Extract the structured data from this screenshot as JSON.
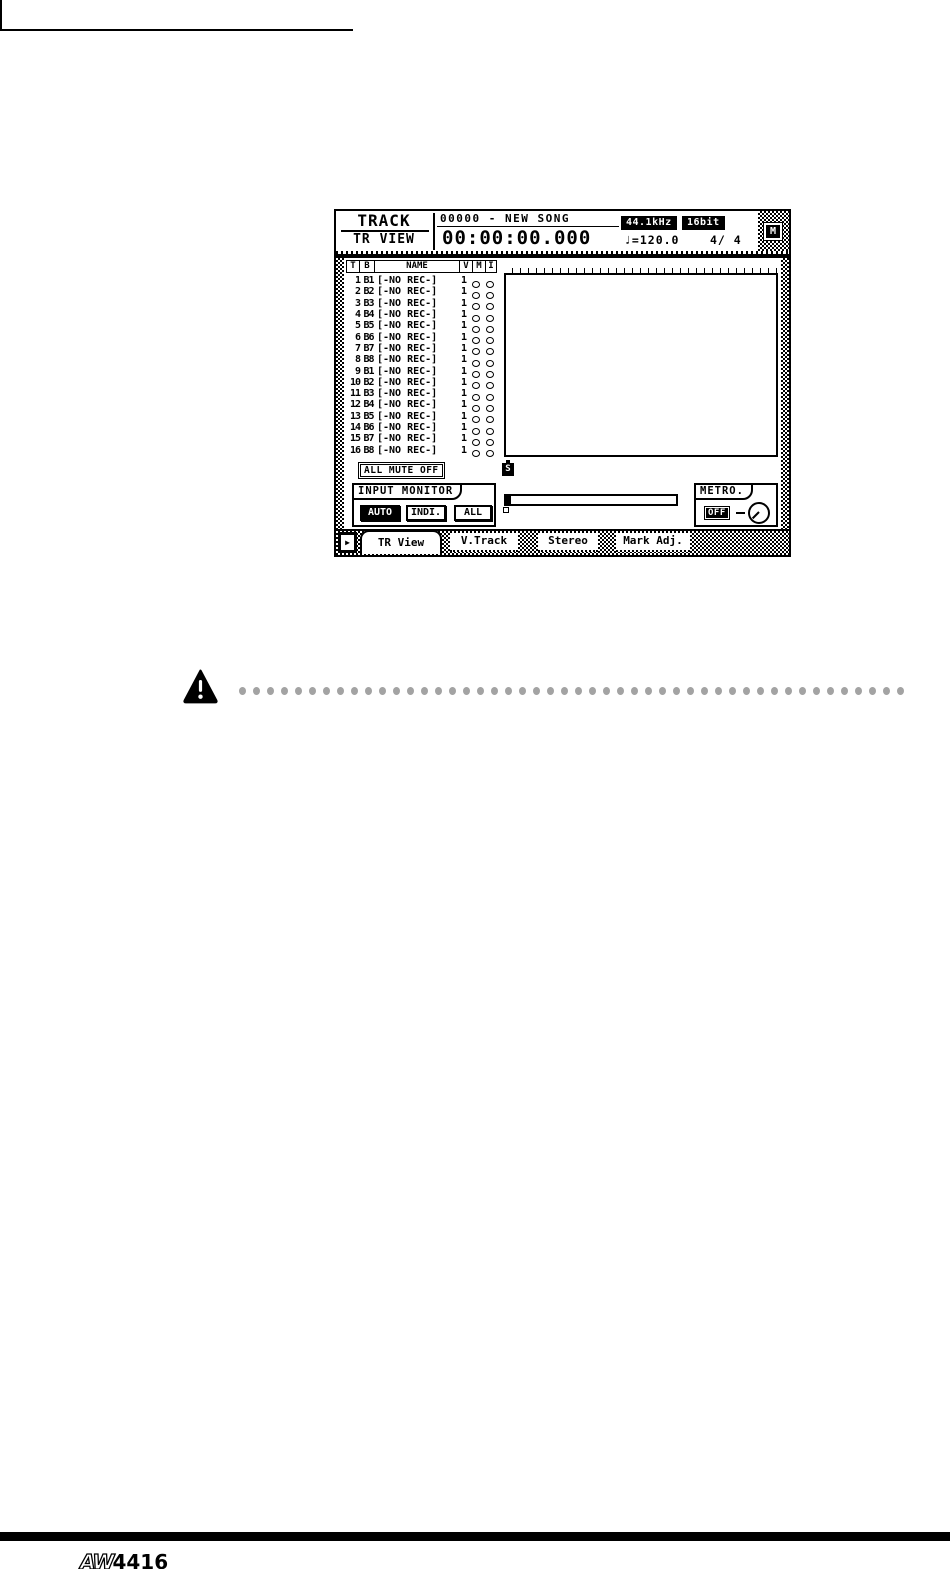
{
  "lcd": {
    "header": {
      "page_group": "TRACK",
      "page_name": "TR VIEW",
      "song_title": "00000 - NEW SONG",
      "time_counter": "00:00:00.000",
      "sample_rate": "44.1kHz",
      "bit_depth": "16bit",
      "tempo": "♩=120.0",
      "time_signature": "4/ 4",
      "midi_indicator": "M"
    },
    "track_table": {
      "headers": [
        "T",
        "B",
        "NAME",
        "V",
        "M",
        "I"
      ],
      "rows": [
        {
          "t": "1",
          "b": "B1",
          "name": "[-NO REC-]",
          "v": "1"
        },
        {
          "t": "2",
          "b": "B2",
          "name": "[-NO REC-]",
          "v": "1"
        },
        {
          "t": "3",
          "b": "B3",
          "name": "[-NO REC-]",
          "v": "1"
        },
        {
          "t": "4",
          "b": "B4",
          "name": "[-NO REC-]",
          "v": "1"
        },
        {
          "t": "5",
          "b": "B5",
          "name": "[-NO REC-]",
          "v": "1"
        },
        {
          "t": "6",
          "b": "B6",
          "name": "[-NO REC-]",
          "v": "1"
        },
        {
          "t": "7",
          "b": "B7",
          "name": "[-NO REC-]",
          "v": "1"
        },
        {
          "t": "8",
          "b": "B8",
          "name": "[-NO REC-]",
          "v": "1"
        },
        {
          "t": "9",
          "b": "B1",
          "name": "[-NO REC-]",
          "v": "1"
        },
        {
          "t": "10",
          "b": "B2",
          "name": "[-NO REC-]",
          "v": "1"
        },
        {
          "t": "11",
          "b": "B3",
          "name": "[-NO REC-]",
          "v": "1"
        },
        {
          "t": "12",
          "b": "B4",
          "name": "[-NO REC-]",
          "v": "1"
        },
        {
          "t": "13",
          "b": "B5",
          "name": "[-NO REC-]",
          "v": "1"
        },
        {
          "t": "14",
          "b": "B6",
          "name": "[-NO REC-]",
          "v": "1"
        },
        {
          "t": "15",
          "b": "B7",
          "name": "[-NO REC-]",
          "v": "1"
        },
        {
          "t": "16",
          "b": "B8",
          "name": "[-NO REC-]",
          "v": "1"
        }
      ]
    },
    "all_mute_button": "ALL MUTE OFF",
    "start_point_marker": "S",
    "input_monitor": {
      "label": "INPUT MONITOR",
      "buttons": [
        {
          "label": "AUTO",
          "active": true
        },
        {
          "label": "INDI.",
          "active": false
        },
        {
          "label": "ALL",
          "active": false
        }
      ]
    },
    "metronome": {
      "label": "METRO.",
      "button": "OFF"
    },
    "tabs": [
      {
        "label": "TR View",
        "active": true
      },
      {
        "label": "V.Track",
        "active": false
      },
      {
        "label": "Stereo",
        "active": false
      },
      {
        "label": "Mark Adj.",
        "active": false
      }
    ],
    "tab_scroll_glyph": "▶"
  },
  "caution": {
    "dot_count": 48,
    "dot_color": "#a3a3a3"
  },
  "footer": {
    "logo_prefix": "AW",
    "logo_suffix": "4416"
  },
  "colors": {
    "ink": "#000000",
    "paper": "#ffffff"
  }
}
